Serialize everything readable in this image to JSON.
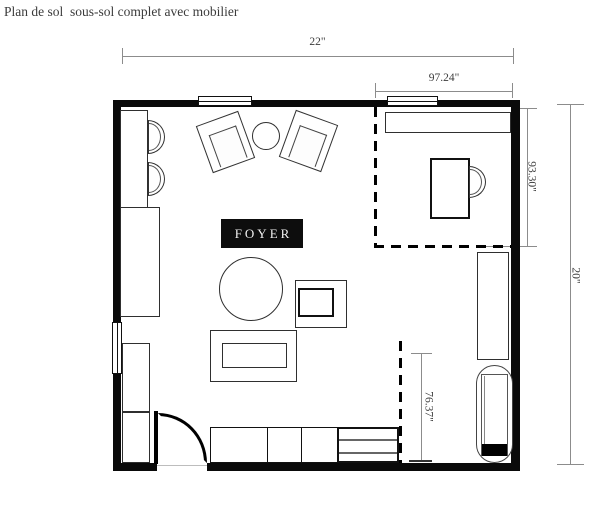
{
  "title": "Plan de sol  sous-sol complet avec mobilier",
  "plan": {
    "room_label": "FOYER",
    "dimensions": {
      "overall_width": "22\"",
      "office_width": "97.24\"",
      "office_depth": "93.30\"",
      "overall_depth": "20\"",
      "right_segment": "76.37\""
    }
  },
  "colors": {
    "wall": "#0a0a0a",
    "furniture_outline": "#2f2f2f",
    "dimension_line": "#8c8c8c",
    "dimension_text": "#3d3d3d",
    "label_background": "#0d0d0d",
    "label_text": "#f2f2f2",
    "title_text": "#3b3b3b",
    "background": "#ffffff"
  }
}
